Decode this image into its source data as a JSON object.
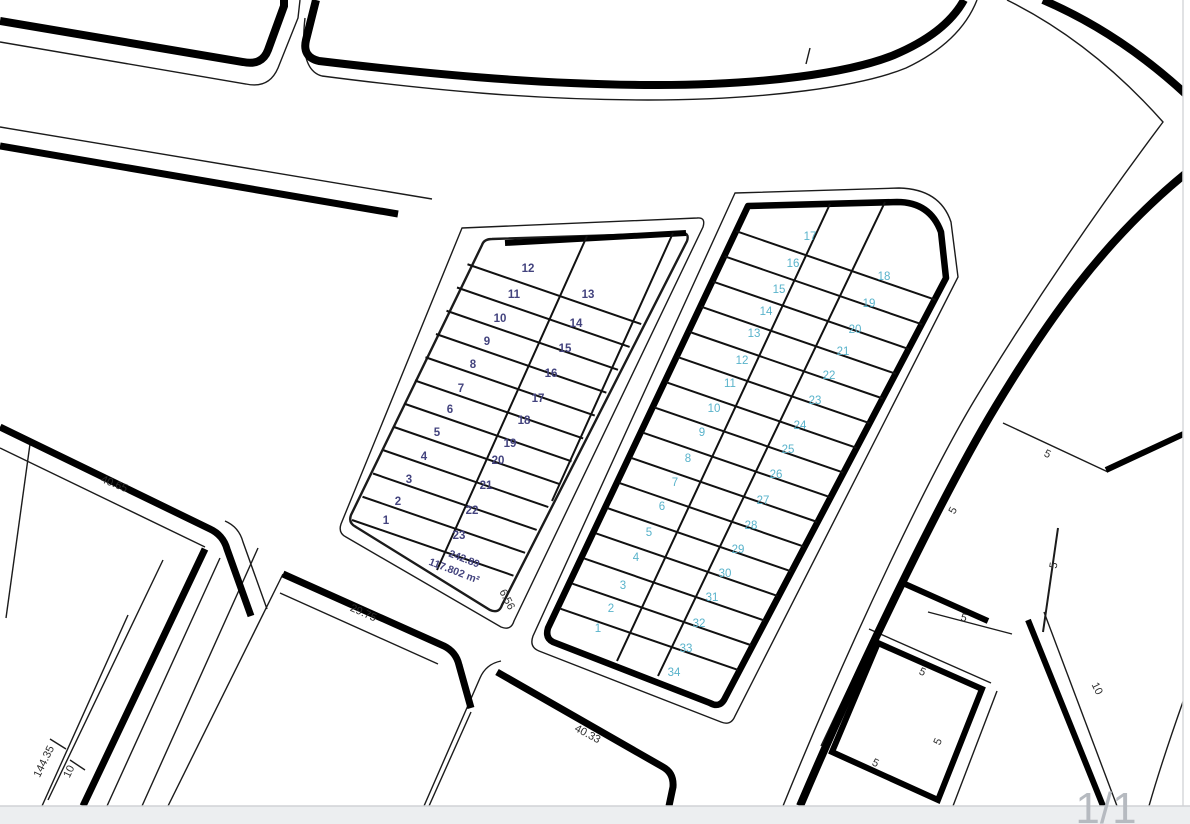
{
  "page": {
    "indicator": "1/1"
  },
  "plan": {
    "blocks": [
      {
        "name": "block-west",
        "number_color": "#43437e",
        "bold": true,
        "parcels": [
          [
            "12",
            528,
            272
          ],
          [
            "11",
            514,
            298
          ],
          [
            "10",
            500,
            322
          ],
          [
            "9",
            487,
            345
          ],
          [
            "8",
            473,
            368
          ],
          [
            "7",
            461,
            392
          ],
          [
            "6",
            450,
            413
          ],
          [
            "5",
            437,
            436
          ],
          [
            "4",
            424,
            460
          ],
          [
            "3",
            409,
            483
          ],
          [
            "2",
            398,
            505
          ],
          [
            "1",
            386,
            524
          ],
          [
            "13",
            588,
            298
          ],
          [
            "14",
            576,
            327
          ],
          [
            "15",
            565,
            352
          ],
          [
            "16",
            551,
            377
          ],
          [
            "17",
            538,
            402
          ],
          [
            "18",
            524,
            424
          ],
          [
            "19",
            510,
            447
          ],
          [
            "20",
            498,
            464
          ],
          [
            "21",
            486,
            489
          ],
          [
            "22",
            472,
            514
          ],
          [
            "23",
            459,
            539
          ]
        ]
      },
      {
        "name": "block-east",
        "number_color": "#59b3cb",
        "bold": false,
        "parcels": [
          [
            "17",
            810,
            240
          ],
          [
            "16",
            793,
            267
          ],
          [
            "15",
            779,
            293
          ],
          [
            "14",
            766,
            315
          ],
          [
            "13",
            754,
            337
          ],
          [
            "12",
            742,
            364
          ],
          [
            "11",
            730,
            387
          ],
          [
            "10",
            714,
            412
          ],
          [
            "9",
            702,
            436
          ],
          [
            "8",
            688,
            462
          ],
          [
            "7",
            675,
            486
          ],
          [
            "6",
            662,
            510
          ],
          [
            "5",
            649,
            536
          ],
          [
            "4",
            636,
            561
          ],
          [
            "3",
            623,
            589
          ],
          [
            "2",
            611,
            612
          ],
          [
            "1",
            598,
            632
          ],
          [
            "18",
            884,
            280
          ],
          [
            "19",
            869,
            307
          ],
          [
            "20",
            855,
            333
          ],
          [
            "21",
            843,
            355
          ],
          [
            "22",
            829,
            379
          ],
          [
            "23",
            815,
            404
          ],
          [
            "24",
            800,
            429
          ],
          [
            "25",
            788,
            453
          ],
          [
            "26",
            776,
            478
          ],
          [
            "27",
            763,
            504
          ],
          [
            "28",
            751,
            529
          ],
          [
            "29",
            738,
            553
          ],
          [
            "30",
            725,
            577
          ],
          [
            "31",
            712,
            601
          ],
          [
            "32",
            699,
            627
          ],
          [
            "33",
            686,
            652
          ],
          [
            "34",
            674,
            676
          ]
        ]
      }
    ],
    "area_label": {
      "line1": "242.89",
      "line2": "117.802 m²",
      "color": "#43437e",
      "x1": 463,
      "y1": 562,
      "x2": 453,
      "y2": 574,
      "rot": 21
    },
    "dimensions": [
      [
        "40.65",
        113,
        487,
        22
      ],
      [
        "29.75",
        362,
        616,
        24
      ],
      [
        "40.33",
        586,
        737,
        28
      ],
      [
        "144.35",
        47,
        763,
        -64
      ],
      [
        "10",
        72,
        773,
        -64
      ],
      [
        "6.56",
        504,
        601,
        63
      ],
      [
        "5",
        1046,
        457,
        25
      ],
      [
        "5",
        956,
        512,
        -62
      ],
      [
        "5",
        1057,
        566,
        -80
      ],
      [
        "5",
        963,
        621,
        15
      ],
      [
        "5",
        921,
        675,
        24
      ],
      [
        "5",
        941,
        743,
        -66
      ],
      [
        "5",
        874,
        766,
        25
      ],
      [
        "10",
        1094,
        690,
        64
      ]
    ],
    "dimension_color": "#2e2e2e",
    "page_gray": "#b6bac0"
  }
}
